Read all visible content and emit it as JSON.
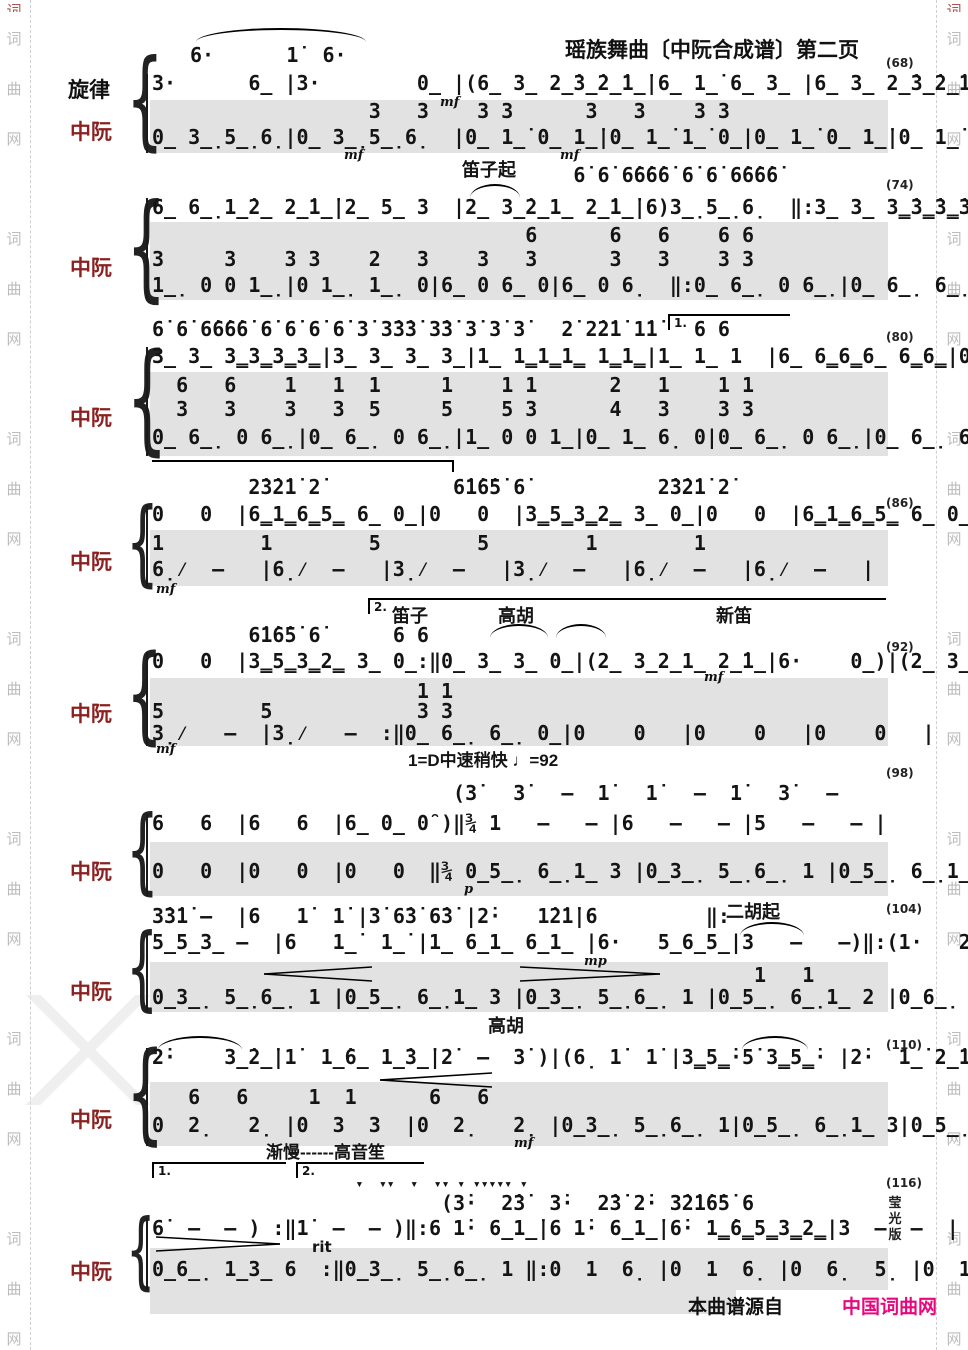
{
  "page": {
    "title": "瑶族舞曲〔中阮合成谱〕第二页",
    "source_prefix": "本曲谱源自",
    "source_site": "中国词曲网",
    "side_watermark": [
      "词",
      "曲",
      "网"
    ],
    "edition_chars": {
      "c1": "莹",
      "c2": "光",
      "c3": "版"
    },
    "site_color": "#e6097e"
  },
  "labels": {
    "melody": "旋律",
    "zhongruan": "中阮"
  },
  "tempo": "1=D中速稍快 ♩=92",
  "annotations": {
    "dizi_qi": "笛子起",
    "dizi": "笛子",
    "gaohu": "高胡",
    "xindi": "新笛",
    "erhu_qi": "二胡起",
    "gaohu2": "高胡",
    "jianman_sheng": "渐慢------高音笙",
    "rit": "rit",
    "volta1": "1.",
    "volta2": "2."
  },
  "dynamics": {
    "mf": "mf",
    "mp": "mp",
    "p": "p"
  },
  "systems": [
    {
      "ref": "(68)",
      "lines": {
        "mel0": "6·      1̇  6·",
        "mel1": "3·      6̲ |3·        0̲ |(6̲ 3̲ 2̲̇3̲̇2̲̇1̲̇|6̲ 1̲̇ 6̲ 3̲ |6̲ 3̲ 2̲̇3̲̇2̲̇1̲̇|6̲ 1̲̇ 6̲ 3̲ |",
        "zr0": "                  3   3    3 3      3   3    3 3",
        "zr1": "0̲ 3̲̣5̲̣6̣|0̲ 3̲̣5̲̣6̣  |0̲ 1̲̇ 0̲ 1̲̇|0̲ 1̲̇ 1̲̇ 0̲|0̲ 1̲̇ 0̲ 1̲̇|0̲ 1̲̇ 1̲̇ 0̲|"
      }
    },
    {
      "ref": "(74)",
      "lines": {
        "mel0": "                                   6̇ 6̇ 6̇6̇6̇6̇ 6̇ 6̇ 6̇6̇6̇6̇",
        "mel1": "6̲ 6̲̣1̲̇2̲ 2̲̇1̲̇|2̲ 5̲ 3  |2̲ 3̲̇2̲1̲ 2̲̇1̲̇|6)3̲̣5̲̣6̣  ‖:3̲ 3̲ 3̳̇3̳̇3̳̇3̳̇|3̲ 3̲ 3̳̇3̳̇3̳̇3̳̇|",
        "zr0": "                               6      6   6    6 6",
        "zr1": "3     3    3 3    2   3    3   3      3   3    3 3",
        "zr2": "1̲̣ 0 0 1̲̣|0 1̲̣ 1̲̣ 0|6̲ 0 6̲ 0|6̲ 0 6̣  ‖:0̲ 6̲̣ 0 6̲̣|0̲ 6̲̣ 6̲̣ 0|"
      }
    },
    {
      "ref": "(80)",
      "lines": {
        "mel0": "6̇ 6̇ 6̇6̇6̇6̇ 6̇ 6̇ 6̇ 6̇ 3̇ 3̇3̇3̇ 3̇3̇ 3̇ 3̇ 3̇   2̇ 2̇2̇1̇ 1̇1̇   6 6",
        "mel1": "3̲ 3̲ 3̳3̳3̳3̳|3̲ 3̲ 3̲ 3̲|1̲ 1̳1̳1̳ 1̳1̳|1̲ 1̲ 1  |6̲ 6̳6̳6̲ 6̳6̳|0̲ 3̲ 3̲ 0̲|",
        "zr0": "  6   6    1   1  1     1    1 1      2   1    1 1",
        "zr1": "  3   3    3   3  5     5    5 3      4   3    3 3",
        "zr2": "0̲ 6̲̣ 0 6̲̣|0̲ 6̲̣ 0 6̲̣|1̲ 0 0 1̲|0̲ 1̲ 6̣ 0|0̲ 6̲̣ 0 6̲̣|0̲ 6̲̣ 6̲̣ 0|"
      }
    },
    {
      "ref": "(86)",
      "lines": {
        "mel0": "        2̇3̇2̇1̇ 2̇           6̇1̇6̇5̇ 6̇           2̇3̇2̇1̇ 2̇",
        "mel1": "0   0  |6̳1̳6̳5̳ 6̲ 0̲|0   0  |3̳5̳3̳2̳ 3̲ 0̲|0   0  |6̳1̳6̳5̳ 6̲ 0̲|",
        "zr0": "1        1        5        5        1        1",
        "zr1": "6̣⁄  –   |6̣⁄  –   |3̣⁄  –   |3̣⁄  –   |6̣⁄  –   |6̣⁄  –   |"
      }
    },
    {
      "ref": "(92)",
      "lines": {
        "mel0": "        6̇1̇6̇5̇ 6̇      6 6",
        "mel1": "0   0  |3̳5̳3̳2̳ 3̲ 0̲:‖0̲ 3̲ 3̲ 0̲|(2̲ 3̲2̲1̲ 2̲̇1̲|6·    0̲)|(2̲ 3̲̇2̲1̲ 2̲̇1̲|",
        "zr0": "                      1 1",
        "zr1": "5        5            3 3",
        "zr2": "3̣⁄   –  |3̣⁄   –  :‖0̲ 6̲̣ 6̲̣ 0̲|0    0   |0    0   |0    0   |"
      }
    },
    {
      "ref": "(98)",
      "lines": {
        "mel0": "                         (3̇   3̇   –  1̇   1̇   –  1̇   3̇   –",
        "mel1": "6   6  |6   6  |6̲ 0̲ 0̑ )‖¾ 1   –   – |6   –   – |5   –   – |",
        "zr1": "0   0  |0   0  |0   0  ‖¾ 0̲5̲̣ 6̲̣1̲ 3 |0̲3̲̣ 5̲̣6̲̣ 1 |0̲5̲̣ 6̲̣1̲ 3 |"
      }
    },
    {
      "ref": "(104)",
      "lines": {
        "mel0": "3̇3̇1̇ –  |6   1̇  1̇ |3̇ 6̇3̇ 6̇3̇ |2̇·   1̇2̇1̇|6         ‖:",
        "mel1": "5̲5̲3̲ –  |6   1̲̇  1̲̇ |1̲ 6̲1̲ 6̲1̲ |6·   5̲6̲5̲|3   –   –)‖:(1·   2̲ 1̲6̲|",
        "zr0": "                                                  1   1",
        "zr1": "0̲3̲̣ 5̲̣6̲̣ 1 |0̲5̲̣ 6̲̣1̲ 3 |0̲3̲̣ 5̲̣6̲̣ 1 |0̲5̲̣ 6̲̣1̲ 2 |0̲6̲̣ 1̲3̲ 6 ‖:0  3̣   3̣ |"
      }
    },
    {
      "ref": "(110)",
      "lines": {
        "mel0": "2̇·    3̲̇2̲̇|1̇  1̲̇6̲ 1̲̇3̲̇|2̇  –  3̇ )|(6̣ 1̇  1̇ |3̳5̳̇·5̇ 3̳5̳̇· |2̇·  1̲̇ 2̲̇1̲|",
        "zr0": "   6   6     1  1      6   6",
        "zr1": "0  2̣   2̣ |0  3  3  |0  2̣   2̣ |0̲3̲̣ 5̲̣6̲̣ 1|0̲5̲̣ 6̲̣1̲ 3|0̲5̲̣ 6̲̣1̲ 2|"
      }
    },
    {
      "ref": "(116)",
      "lines": {
        "stc": "                          ▾  ▾▾  ▾  ▾▾ ▾ ▾▾▾▾▾ ▾",
        "mel0": "                        (3̇·  2̇3̇  3̇·  2̇3̇ 2̇· 3̇2̇1̇6̇5̇ 6",
        "mel1": "6̇  –  – ) :‖1̇  –  – )‖:6 1̇· 6̲1̲̇|6 1̇· 6̲1̲̇|6̇· 1̳̇6̳5̳3̳2̳|3  –  –  |",
        "zr1": "0̲6̲̣ 1̲3̲ 6  :‖0̲3̲̣ 5̲̣6̲̣ 1 ‖:0  1  6̣ |0  1  6̣ |0  6̣  5̣ |0  1  6̣  |"
      }
    }
  ]
}
